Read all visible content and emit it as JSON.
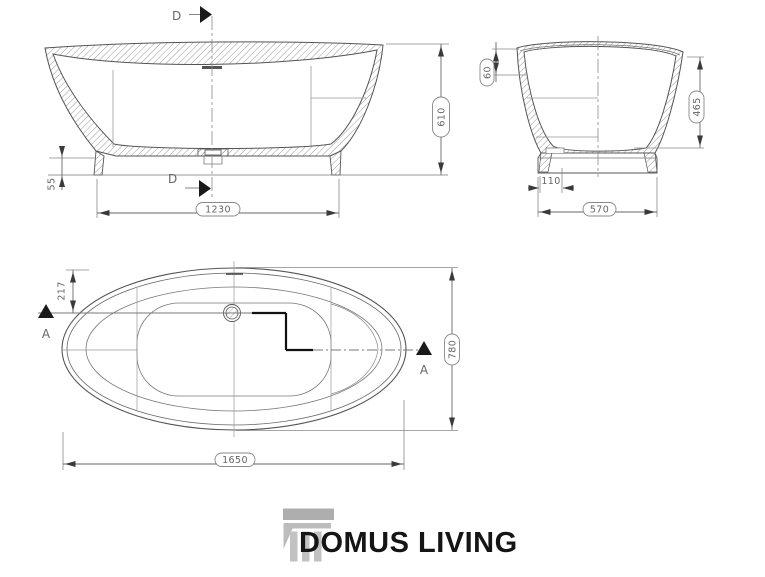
{
  "side_view": {
    "section_label": "D",
    "dim_height": "610",
    "dim_base_length": "1230",
    "dim_plinth_height": "55"
  },
  "section_view": {
    "dim_rim": "60",
    "dim_depth": "465",
    "dim_step": "110",
    "dim_base_width": "570"
  },
  "plan_view": {
    "section_label": "A",
    "dim_drain_offset": "217",
    "dim_width": "780",
    "dim_length": "1650"
  },
  "logo": {
    "brand": "DOMUS LIVING"
  },
  "colors": {
    "line": "#555555",
    "thin_line": "#8a8a8a",
    "dim_text": "#666666",
    "arrow": "#1a1a1a",
    "logo_gray": "#bcbcbc",
    "logo_text": "#151515",
    "background": "#ffffff"
  }
}
